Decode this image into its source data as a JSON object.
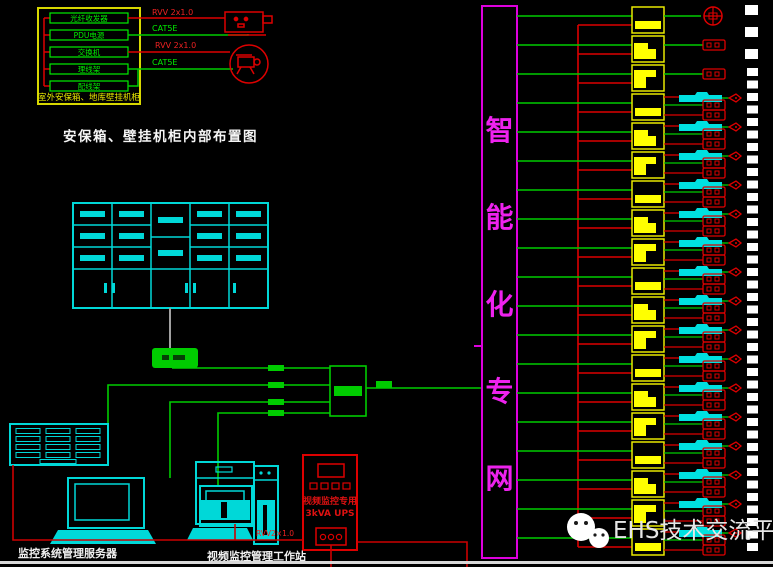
{
  "diagram_title": "安保箱、壁挂机柜内部布置图",
  "wall_cabinet": {
    "caption": "室外安保箱、地库壁挂机柜",
    "devices": [
      "光纤收发器",
      "PDU电源",
      "交换机",
      "理线架",
      "配线架"
    ],
    "wire_labels": {
      "power_1": "RVV 2x1.0",
      "data_1": "CAT5E",
      "power_2": "RVV 2x1.0",
      "data_2": "CAT5E"
    }
  },
  "network": {
    "trunk_name": "智能化专网",
    "trunk_chars": [
      "智",
      "能",
      "化",
      "专",
      "网"
    ]
  },
  "camera_column": {
    "module_count": 19,
    "simple_modules": 3
  },
  "video_wall": {
    "cols": 3,
    "rows": 4
  },
  "control_room": {
    "server_caption": "监控系统管理服务器",
    "workstation_caption": "视频监控管理工作站",
    "ups_line1": "视频监控专用",
    "ups_line2": "3kVA UPS",
    "cable_label": "RVV2×1.0"
  },
  "watermark": {
    "text": "EHS技术交流平台"
  },
  "colors": {
    "wire_green": "#00cc00",
    "bright_green": "#00ee00",
    "wire_red": "#dd0000",
    "cyan": "#00d8d8",
    "yellow": "#ffff00",
    "yellow_stroke": "#d8d800",
    "magenta": "#dd00dd",
    "magenta_text": "#ee22ee",
    "text_white": "#f0f0f0",
    "gray_line": "#a0a0a0",
    "watermark_gray": "#e6e6e6"
  }
}
